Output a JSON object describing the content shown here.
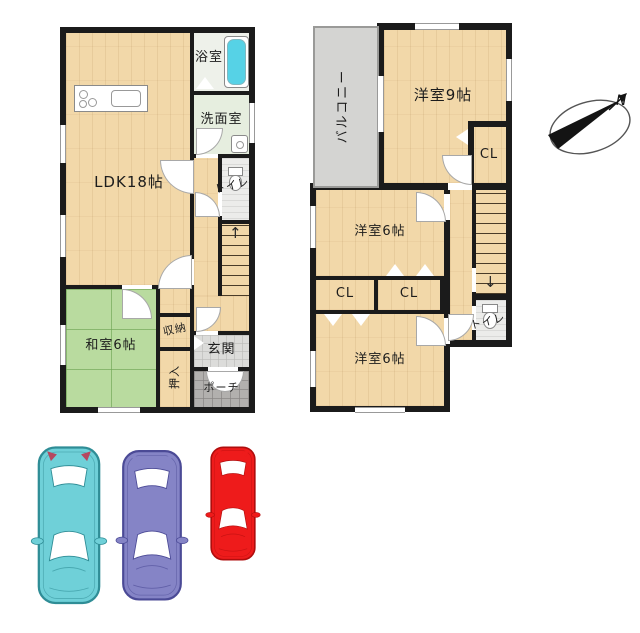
{
  "title": "2-story house floor plan with parking",
  "colors": {
    "wall": "#1b1b1b",
    "wood_floor": "#f2d8a9",
    "tatami": "#b9db9f",
    "bath_floor": "#e6eedf",
    "toilet_floor": "#ececea",
    "genkan_tile": "#dcdcda",
    "porch_tile": "#b2b0ae",
    "balcony": "#d4d4d2",
    "bathtub": "#56d2e6"
  },
  "floor1": {
    "rooms": {
      "ldk": "LDK18帖",
      "bath": "浴室",
      "wash": "洗面室",
      "toilet": "トイレ",
      "washitsu": "和室6帖",
      "storage": "収納",
      "oshiire": "押入",
      "genkan": "玄関",
      "porch": "ポーチ"
    },
    "stairs_arrow": "↑"
  },
  "floor2": {
    "rooms": {
      "balcony": "バルコニー",
      "west9": "洋室9帖",
      "cl1": "CL",
      "west6a": "洋室6帖",
      "cl2": "CL",
      "cl3": "CL",
      "west6b": "洋室6帖",
      "toilet": "トイレ"
    },
    "stairs_arrow": "↓"
  },
  "compass": {
    "label": "N"
  },
  "cars": [
    {
      "name": "teal-car",
      "body": "#6fd0d8",
      "outline": "#2f8d96",
      "detail": "#b5485f"
    },
    {
      "name": "purple-car",
      "body": "#8584c6",
      "outline": "#4b4a96",
      "detail": "#8584c6"
    },
    {
      "name": "red-car",
      "body": "#ee1b1b",
      "outline": "#b00d0d",
      "detail": "#ee1b1b"
    }
  ]
}
